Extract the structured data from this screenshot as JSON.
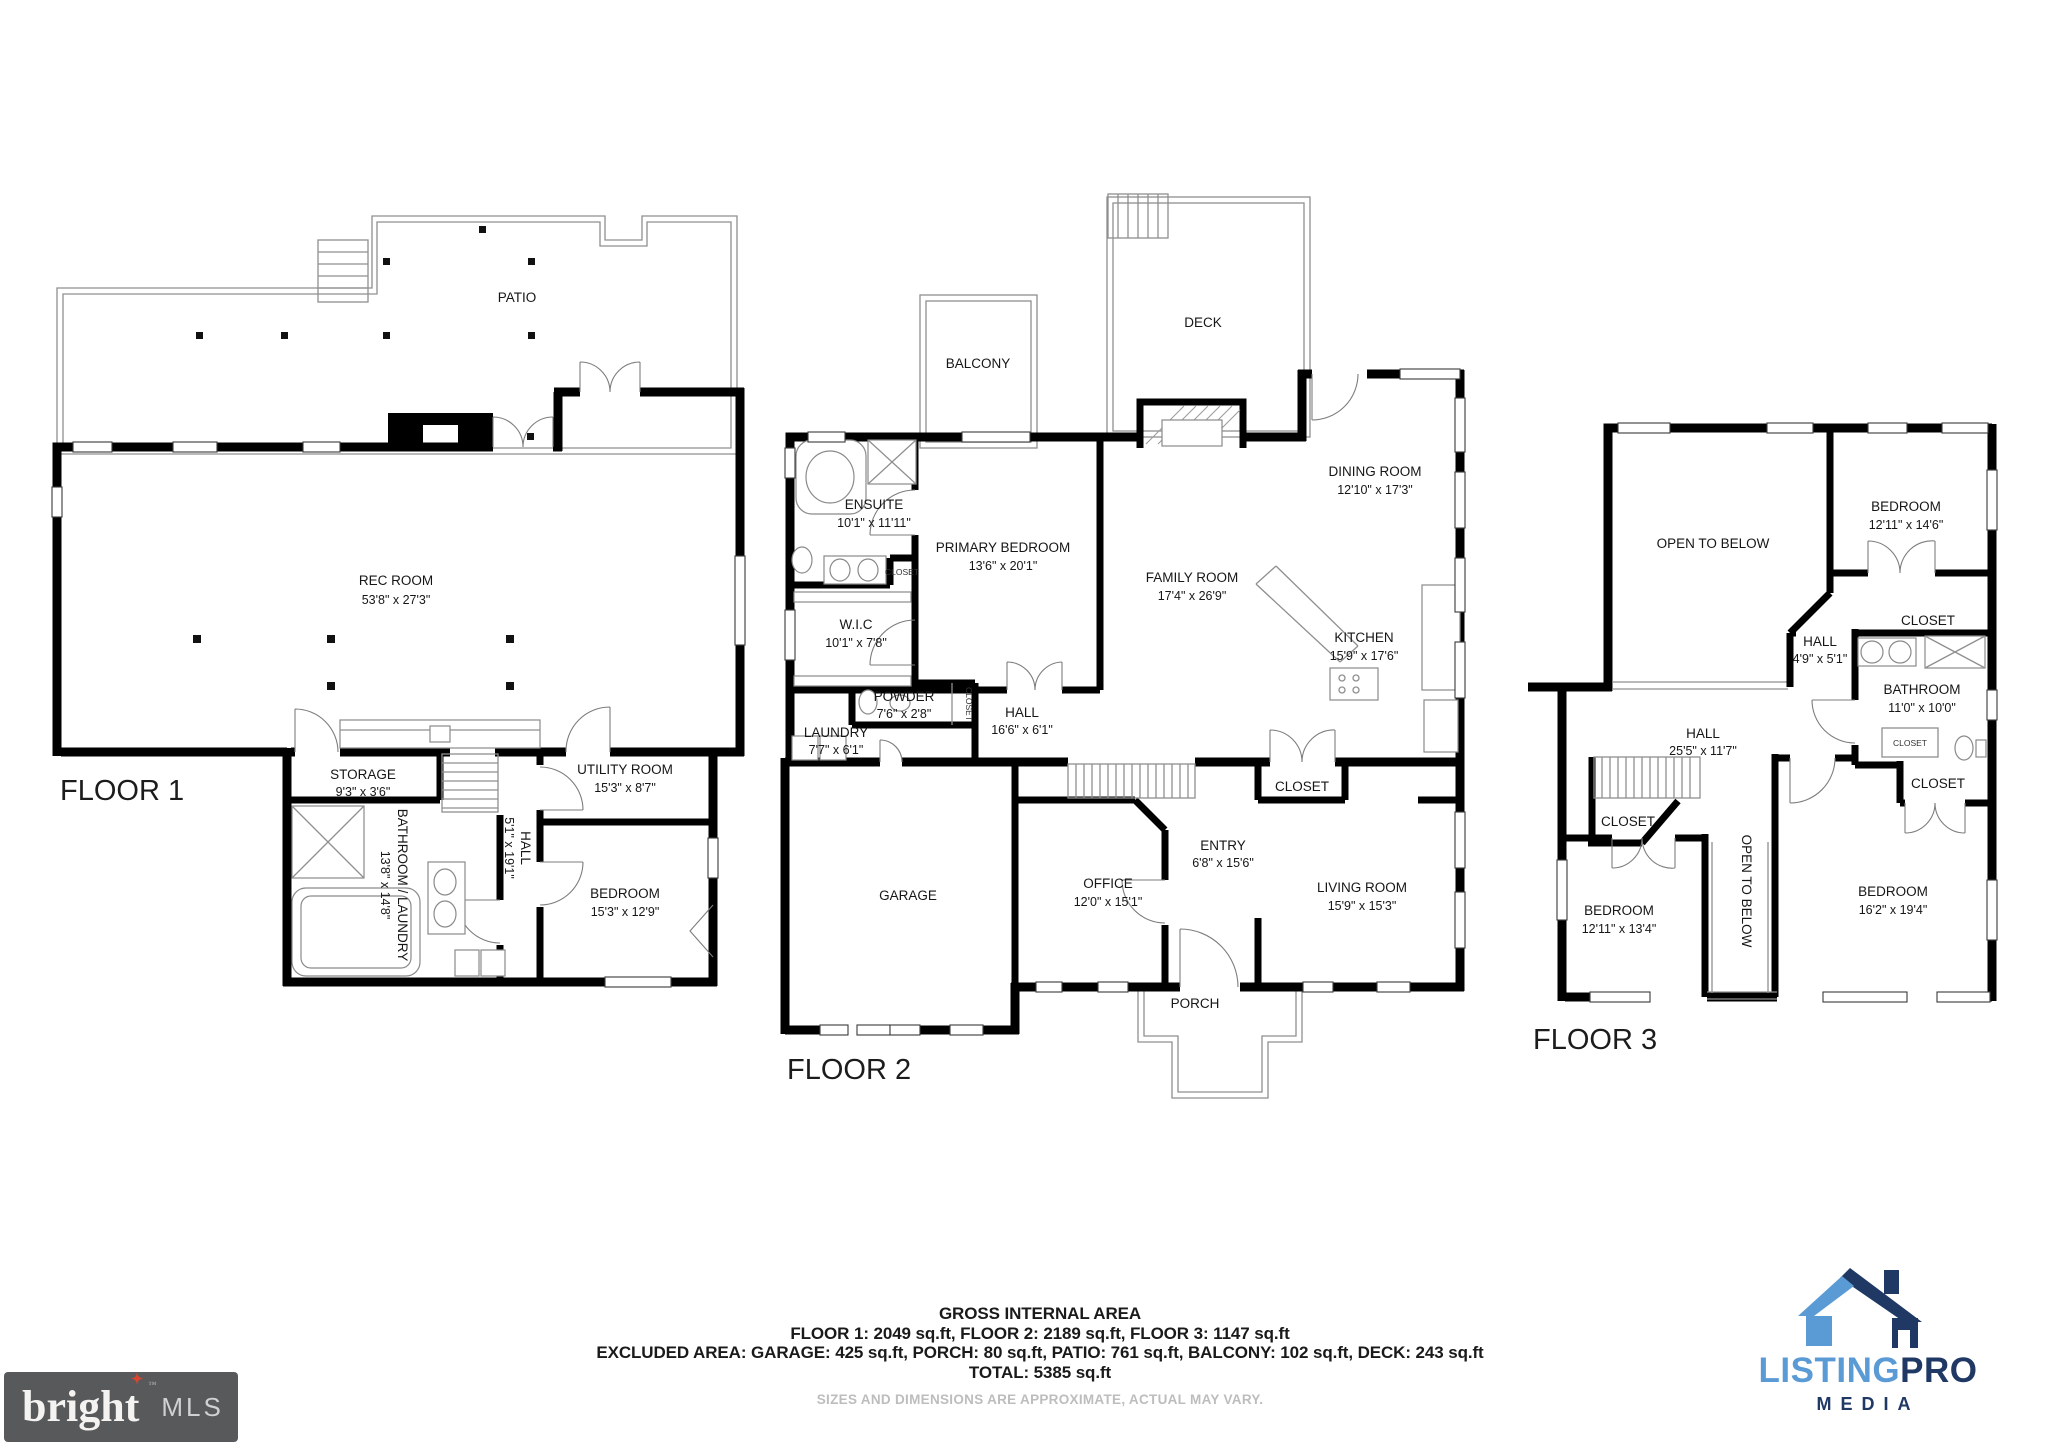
{
  "floor1": {
    "title": "FLOOR 1",
    "patio": {
      "label": "PATIO"
    },
    "rec": {
      "label": "REC ROOM",
      "dims": "53'8\" x 27'3\""
    },
    "storage": {
      "label": "STORAGE",
      "dims": "9'3\" x 3'6\""
    },
    "bath": {
      "label": "BATHROOM / LAUNDRY",
      "dims": "13'8\" x 14'8\""
    },
    "hall": {
      "label": "HALL",
      "dims": "5'1\" x 19'1\""
    },
    "utility": {
      "label": "UTILITY ROOM",
      "dims": "15'3\" x 8'7\""
    },
    "bedroom": {
      "label": "BEDROOM",
      "dims": "15'3\" x 12'9\""
    }
  },
  "floor2": {
    "title": "FLOOR 2",
    "balcony": {
      "label": "BALCONY"
    },
    "deck": {
      "label": "DECK"
    },
    "ensuite": {
      "label": "ENSUITE",
      "dims": "10'1\" x 11'11\""
    },
    "ensuite_closet": {
      "label": "CLOSET"
    },
    "primary": {
      "label": "PRIMARY BEDROOM",
      "dims": "13'6\" x 20'1\""
    },
    "wic": {
      "label": "W.I.C",
      "dims": "10'1\" x 7'8\""
    },
    "powder": {
      "label": "POWDER",
      "dims": "7'6\" x 2'8\""
    },
    "powder_closet": {
      "label": "CLOSET"
    },
    "laundry": {
      "label": "LAUNDRY",
      "dims": "7'7\" x 6'1\""
    },
    "hall": {
      "label": "HALL",
      "dims": "16'6\" x 6'1\""
    },
    "dining": {
      "label": "DINING ROOM",
      "dims": "12'10\" x 17'3\""
    },
    "family": {
      "label": "FAMILY ROOM",
      "dims": "17'4\" x 26'9\""
    },
    "kitchen": {
      "label": "KITCHEN",
      "dims": "15'9\" x 17'6\""
    },
    "garage": {
      "label": "GARAGE"
    },
    "office": {
      "label": "OFFICE",
      "dims": "12'0\" x 15'1\""
    },
    "entry": {
      "label": "ENTRY",
      "dims": "6'8\" x 15'6\""
    },
    "entry_closet": {
      "label": "CLOSET"
    },
    "living": {
      "label": "LIVING ROOM",
      "dims": "15'9\" x 15'3\""
    },
    "porch": {
      "label": "PORCH"
    }
  },
  "floor3": {
    "title": "FLOOR 3",
    "open1": {
      "label": "OPEN TO BELOW"
    },
    "bedroom_a": {
      "label": "BEDROOM",
      "dims": "12'11\" x 14'6\""
    },
    "hall_a": {
      "label": "HALL",
      "dims": "4'9\" x 5'1\""
    },
    "closet_a": {
      "label": "CLOSET"
    },
    "bathroom": {
      "label": "BATHROOM",
      "dims": "11'0\" x 10'0\""
    },
    "closet_b": {
      "label": "CLOSET"
    },
    "closet_c": {
      "label": "CLOSET"
    },
    "hall_b": {
      "label": "HALL",
      "dims": "25'5\" x 11'7\""
    },
    "closet_d": {
      "label": "CLOSET"
    },
    "bedroom_b": {
      "label": "BEDROOM",
      "dims": "12'11\" x 13'4\""
    },
    "open2": {
      "label": "OPEN TO BELOW"
    },
    "bedroom_c": {
      "label": "BEDROOM",
      "dims": "16'2\" x 19'4\""
    }
  },
  "summary": {
    "title": "GROSS INTERNAL AREA",
    "line1": "FLOOR 1: 2049 sq.ft, FLOOR 2: 2189 sq.ft, FLOOR 3: 1147 sq.ft",
    "line2": "EXCLUDED AREA: GARAGE: 425 sq.ft, PORCH: 80 sq.ft, PATIO: 761 sq.ft, BALCONY: 102 sq.ft, DECK: 243 sq.ft",
    "total": "TOTAL: 5385 sq.ft",
    "disclaimer": "SIZES AND DIMENSIONS ARE APPROXIMATE, ACTUAL MAY VARY."
  },
  "branding": {
    "bright": {
      "name": "bright",
      "star": "✦",
      "tm": "™",
      "suffix": "MLS",
      "bg": "#58595B",
      "star_color": "#D6452F"
    },
    "listingpro": {
      "listing": "LISTING",
      "pro": "PRO",
      "media": "MEDIA",
      "light": "#5B9BD5",
      "navy": "#1F3864"
    }
  }
}
